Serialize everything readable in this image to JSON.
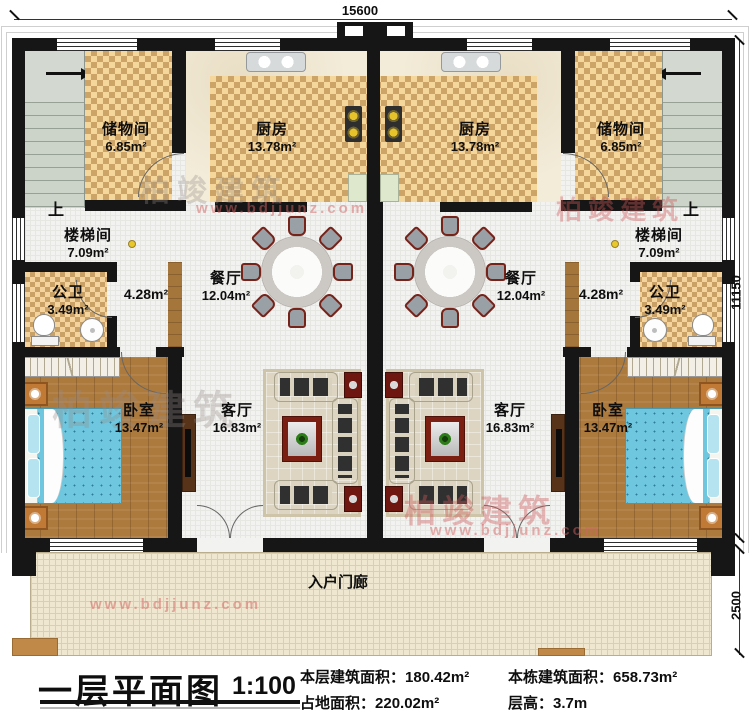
{
  "dimensions": {
    "top": "15600",
    "side": "11150",
    "porch": "2500"
  },
  "porch_label": "入户门廊",
  "units": {
    "left": {
      "up": "上",
      "storage": {
        "name": "储物间",
        "area": "6.85m²"
      },
      "kitchen": {
        "name": "厨房",
        "area": "13.78m²"
      },
      "stairwell": {
        "name": "楼梯间",
        "area": "7.09m²"
      },
      "bath": {
        "name": "公卫",
        "area": "3.49m²"
      },
      "corridor": {
        "area": "4.28m²"
      },
      "dining": {
        "name": "餐厅",
        "area": "12.04m²"
      },
      "living": {
        "name": "客厅",
        "area": "16.83m²"
      },
      "bedroom": {
        "name": "卧室",
        "area": "13.47m²"
      }
    },
    "right": {
      "up": "上",
      "storage": {
        "name": "储物间",
        "area": "6.85m²"
      },
      "kitchen": {
        "name": "厨房",
        "area": "13.78m²"
      },
      "stairwell": {
        "name": "楼梯间",
        "area": "7.09m²"
      },
      "bath": {
        "name": "公卫",
        "area": "3.49m²"
      },
      "corridor": {
        "area": "4.28m²"
      },
      "dining": {
        "name": "餐厅",
        "area": "12.04m²"
      },
      "living": {
        "name": "客厅",
        "area": "16.83m²"
      },
      "bedroom": {
        "name": "卧室",
        "area": "13.47m²"
      }
    }
  },
  "title_block": {
    "title": "一层平面图",
    "scale": "1:100",
    "items": [
      {
        "label": "本层建筑面积：",
        "value": "180.42m²"
      },
      {
        "label": "占地面积：",
        "value": "220.02m²"
      },
      {
        "label": "本栋建筑面积：",
        "value": "658.73m²"
      },
      {
        "label": "层高：",
        "value": "3.7m"
      }
    ]
  },
  "watermark": {
    "brand": "柏竣建筑",
    "url": "www.bdjjunz.com"
  },
  "colors": {
    "wall": "#161616",
    "checker_light": "#f6d79b",
    "checker_dark": "#cda467",
    "wood": "#ad7a3d",
    "bed": "#6ec7de",
    "accent_red": "#7a1f12"
  }
}
